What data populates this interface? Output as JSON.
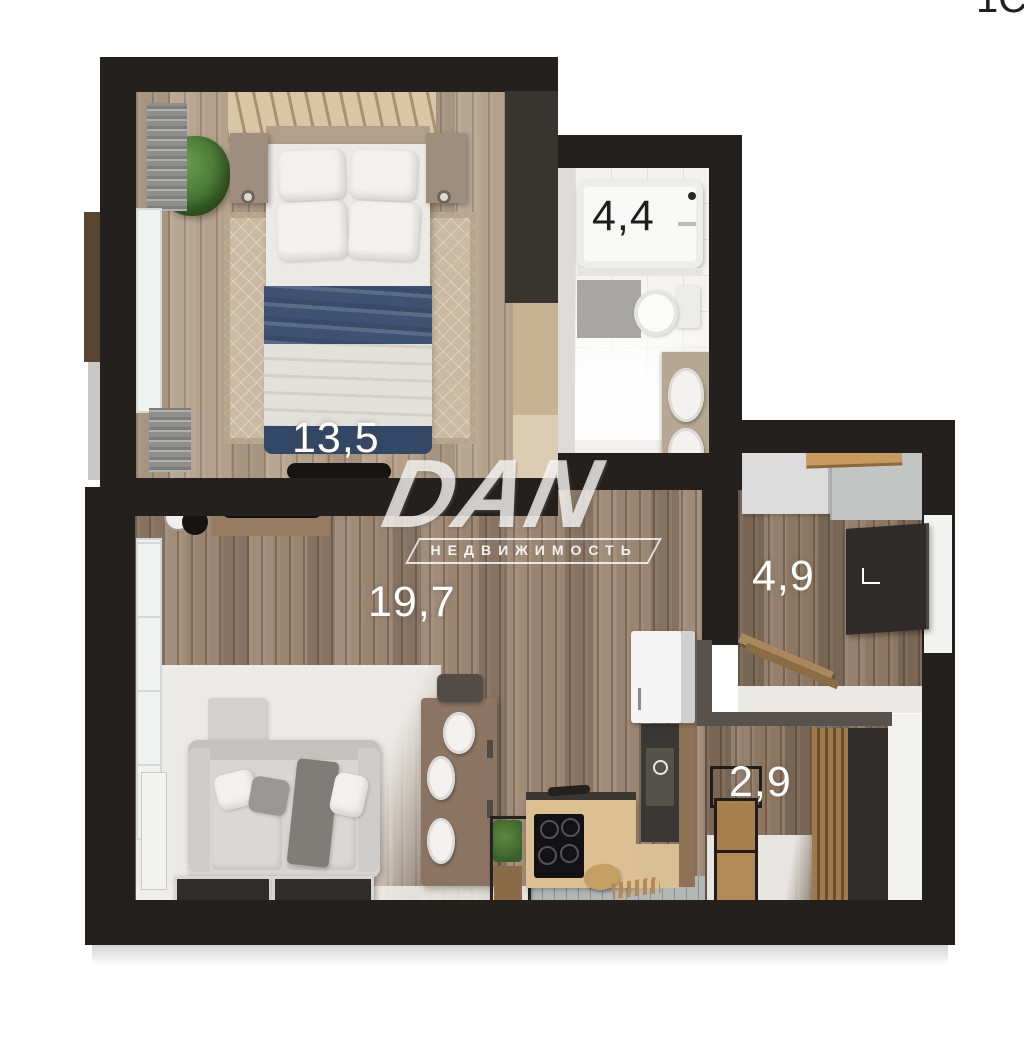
{
  "title": "apartment-floor-plan-3d",
  "watermark": {
    "brand": "DAN",
    "subtitle": "НЕДВИЖИМОСТЬ"
  },
  "corner_text": "1С",
  "rooms": {
    "bedroom": {
      "name": "bedroom",
      "area": "13,5"
    },
    "bathroom": {
      "name": "bathroom",
      "area": "4,4"
    },
    "living": {
      "name": "living-kitchen",
      "area": "19,7"
    },
    "hallway": {
      "name": "hallway",
      "area": "4,9"
    },
    "closet": {
      "name": "closet",
      "area": "2,9"
    }
  },
  "colors": {
    "background": "#ffffff",
    "wall": "#23201d",
    "bedroom_floor": "#b4a08b",
    "living_floor": "#9b8572",
    "hall_floor": "#8d7763",
    "bath_tile": "#f4f3f1",
    "blanket_navy": "#3e5373",
    "sofa_gray": "#d8d6d2",
    "counter_wood": "#dcc094",
    "shelf_wood": "#c79b60",
    "plant_green": "#4e7c38",
    "label_light": "#ffffff",
    "label_dark": "#1d1d1d"
  }
}
